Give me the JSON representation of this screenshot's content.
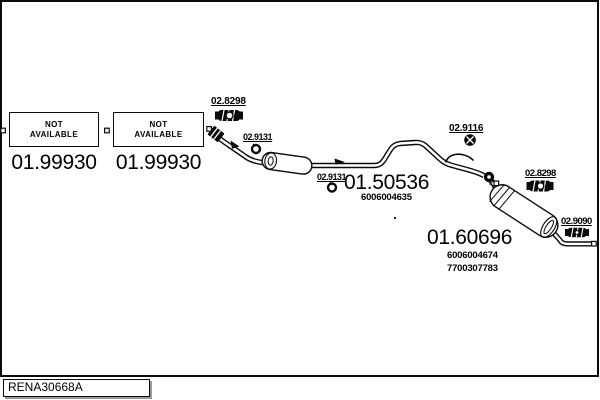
{
  "colors": {
    "ink": "#0a0a0a",
    "paper": "#ffffff",
    "shadow": "#999999"
  },
  "drawing_code": {
    "label": "RENA30668A"
  },
  "unavailable_boxes": [
    {
      "line1": "NOT",
      "line2": "AVAILABLE",
      "part_number": "01.99930"
    },
    {
      "line1": "NOT",
      "line2": "AVAILABLE",
      "part_number": "01.99930"
    }
  ],
  "parts": {
    "center_silencer": {
      "part_number": "01.50536",
      "oe_numbers": [
        "6006004635"
      ]
    },
    "rear_silencer": {
      "part_number": "01.60696",
      "oe_numbers": [
        "6006004674",
        "7700307783"
      ]
    }
  },
  "fasteners": [
    {
      "label": "02.8298",
      "icon": "pipe-clamp-icon"
    },
    {
      "label": "02.9131",
      "icon": "hanger-ring-icon"
    },
    {
      "label": "02.9131",
      "icon": "hanger-ring-icon"
    },
    {
      "label": "02.9116",
      "icon": "nut-icon"
    },
    {
      "label": "02.8298",
      "icon": "pipe-clamp-icon"
    },
    {
      "label": "02.9090",
      "icon": "tail-clamp-icon"
    }
  ]
}
